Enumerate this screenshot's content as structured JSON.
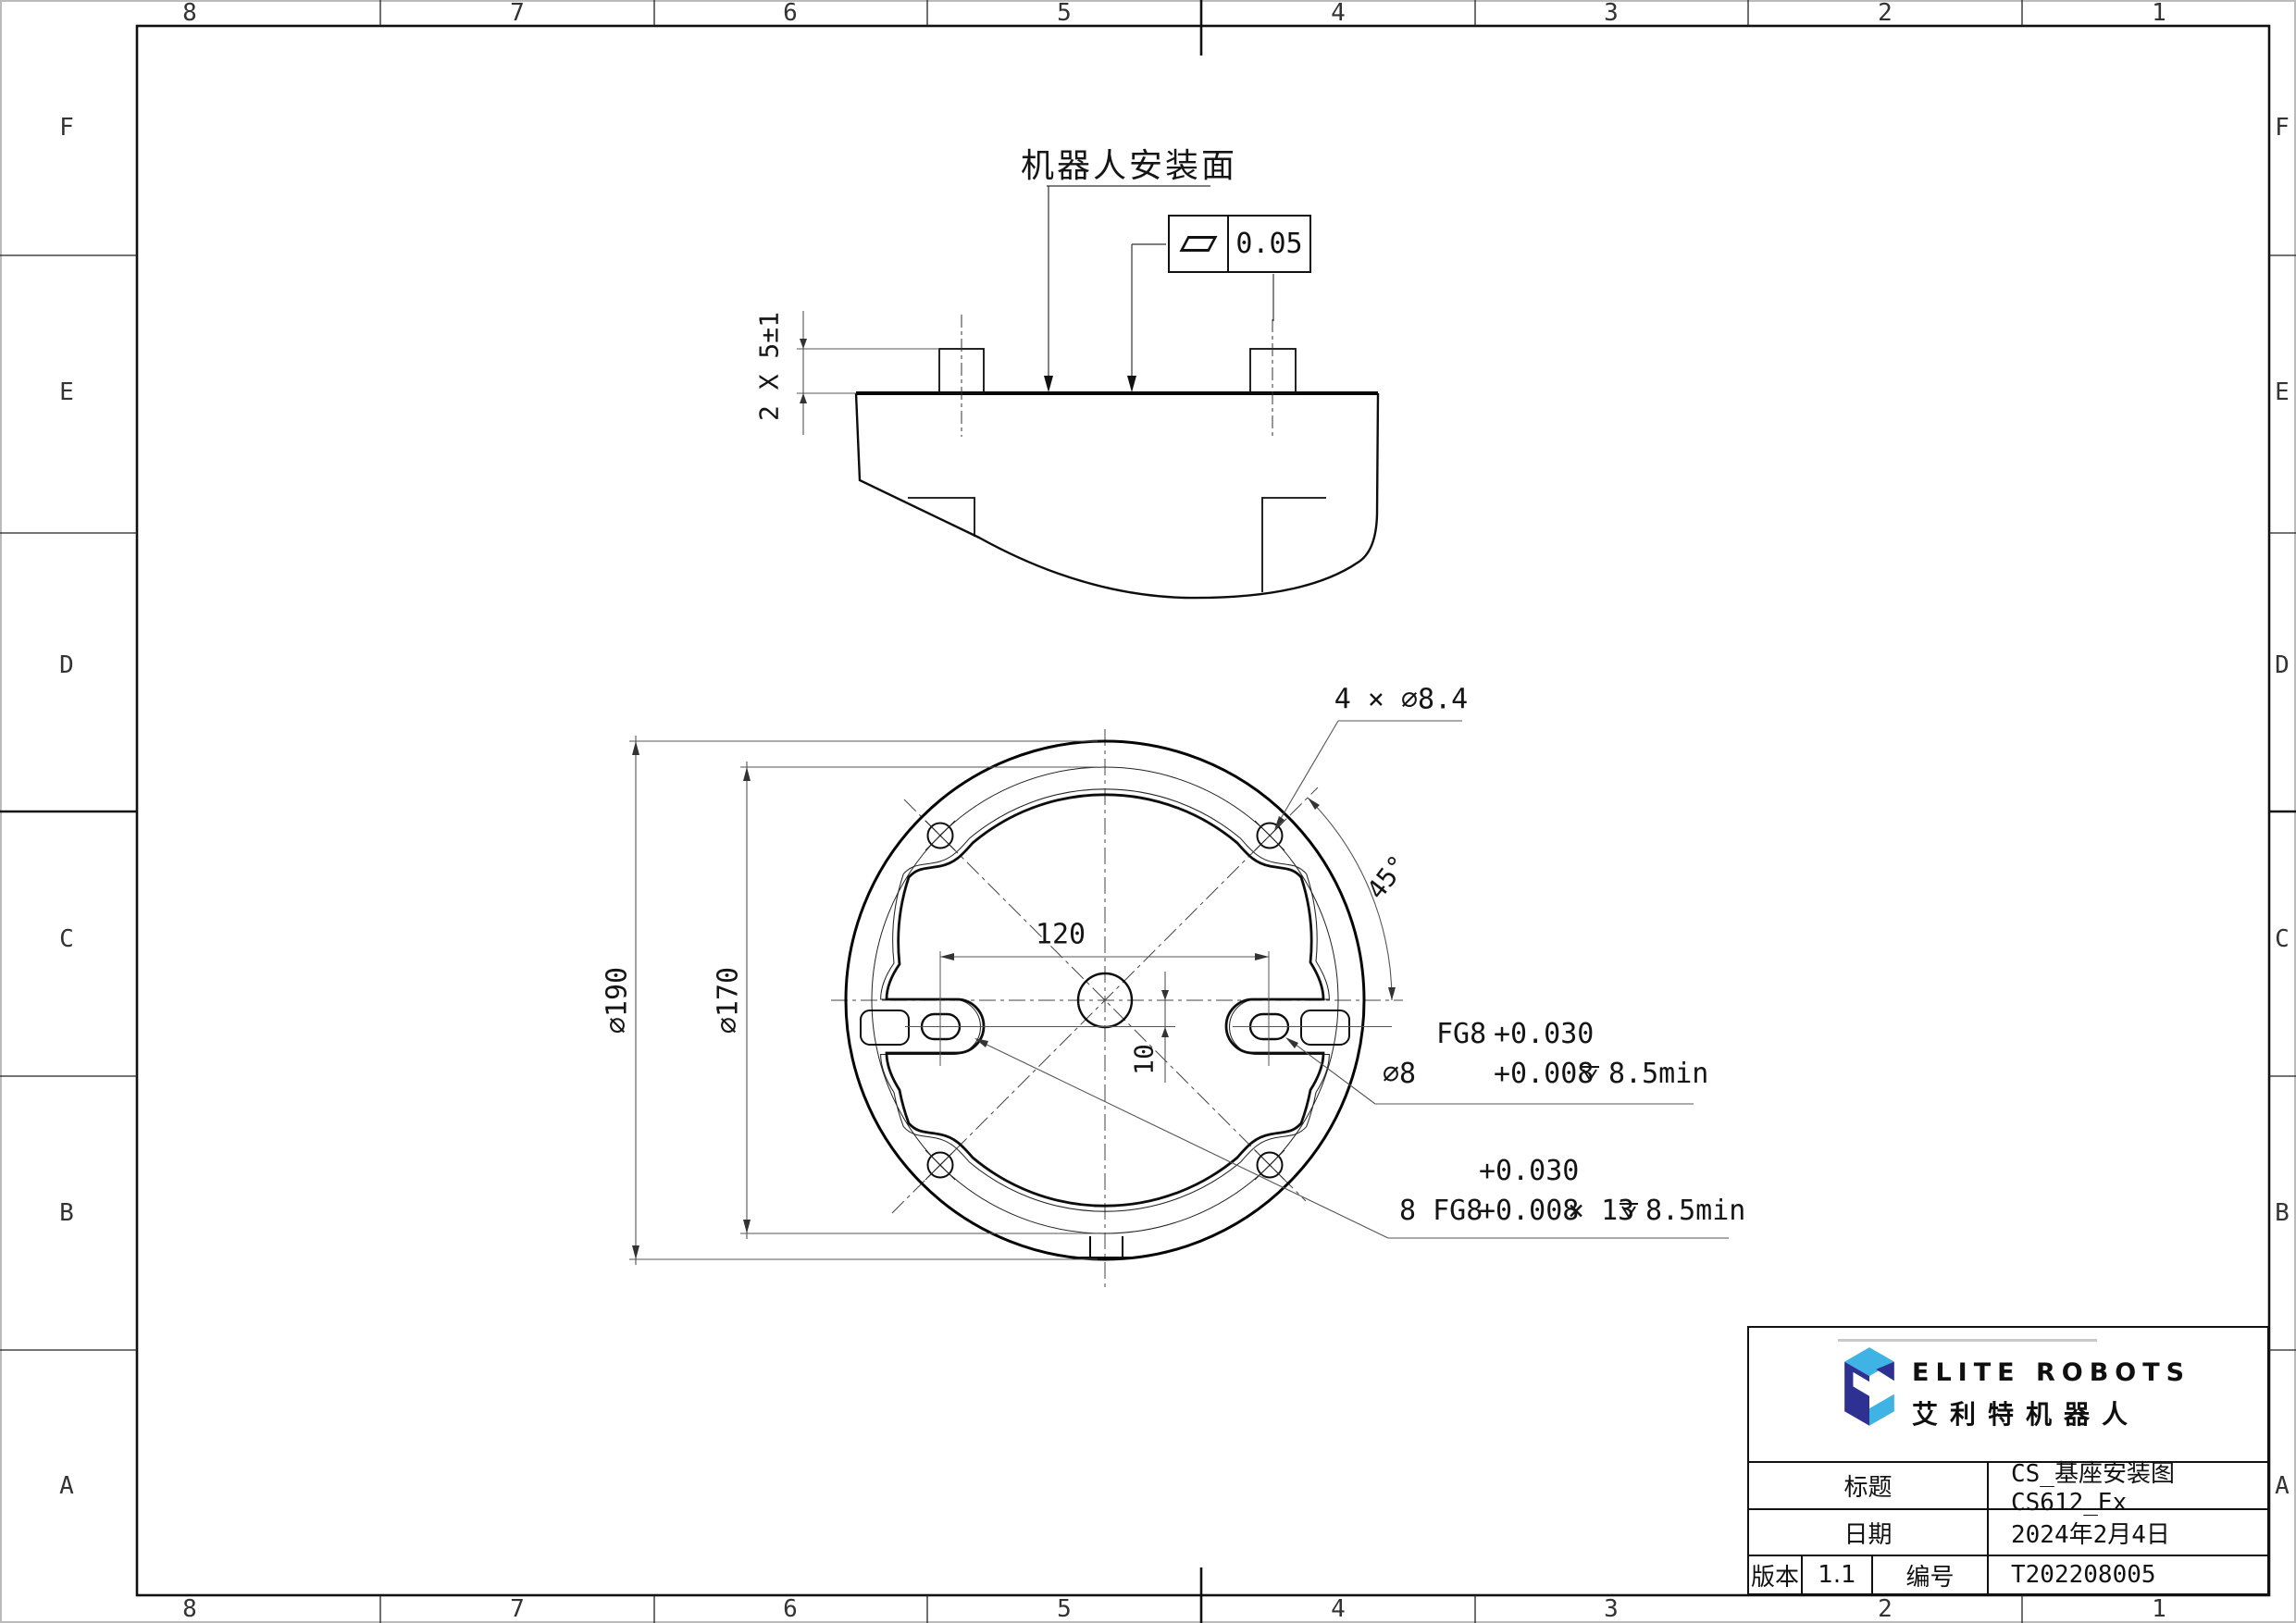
{
  "sheet": {
    "grid_cols": [
      "8",
      "7",
      "6",
      "5",
      "4",
      "3",
      "2",
      "1"
    ],
    "grid_rows": [
      "F",
      "E",
      "D",
      "C",
      "B",
      "A"
    ]
  },
  "side_view": {
    "surface_label": "机器人安装面",
    "flatness_value": "0.05",
    "pin_dim": "2 X 5±1"
  },
  "flange_view": {
    "holes_label": "4 × ⌀8.4",
    "angle_label": "45°",
    "dia_outer": "⌀190",
    "dia_pitch": "⌀170",
    "dim_spacing": "120",
    "dim_offset": "10",
    "slot_note": {
      "dia": "⌀8",
      "fit": "FG8",
      "tol_upper": "+0.030",
      "tol_lower": "+0.008",
      "depth": "8.5min"
    },
    "pattern_note": {
      "lead": "8 FG8",
      "tol_upper": "+0.030",
      "tol_lower": "+0.008",
      "length": "× 13",
      "depth": "8.5min"
    }
  },
  "title_block": {
    "brand_en": "ELITE ROBOTS",
    "brand_cn": "艾利特机器人",
    "title_label": "标题",
    "title_value": "CS_基座安装图 CS612_Ex",
    "date_label": "日期",
    "date_value": "2024年2月4日",
    "version_label": "版本",
    "version_value": "1.1",
    "number_label": "编号",
    "number_value": "T202208005",
    "colors": {
      "brand_light": "#3FB3E4",
      "brand_dark": "#2E3192"
    }
  }
}
